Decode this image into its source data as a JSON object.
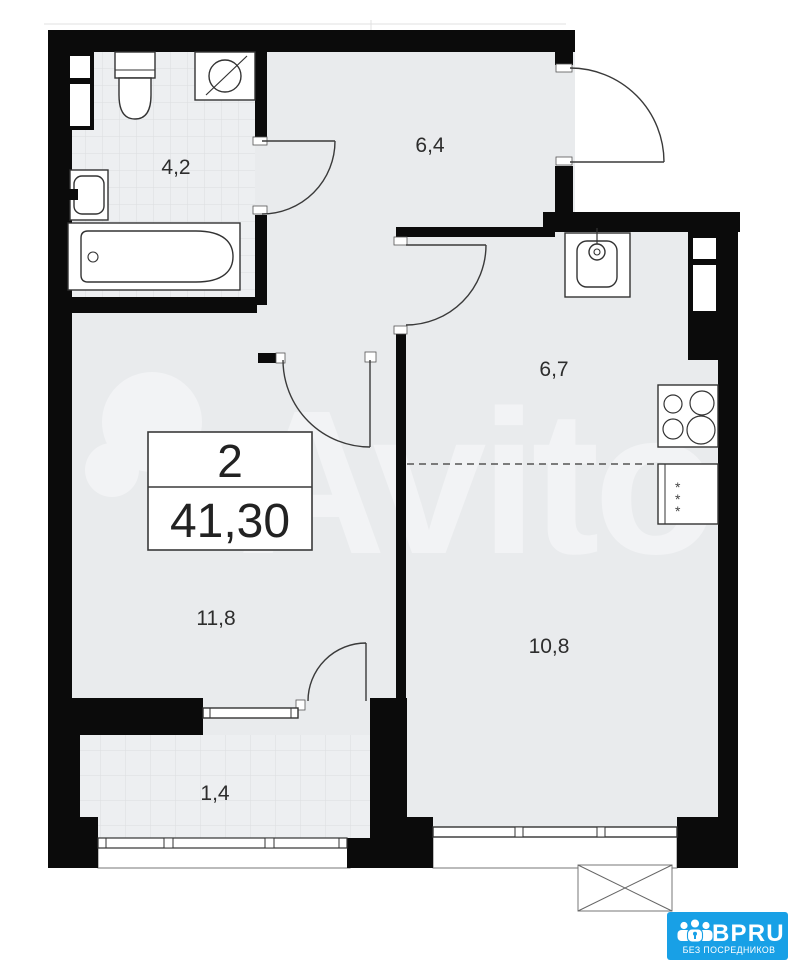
{
  "plan": {
    "info_box": {
      "rooms_count": "2",
      "total_area": "41,30"
    },
    "rooms": {
      "bathroom": "4,2",
      "hallway": "6,4",
      "kitchen": "6,7",
      "living_room": "11,8",
      "room": "10,8",
      "balcony": "1,4"
    },
    "watermark": "Avito"
  },
  "footer_logo": {
    "brand": "BPRU",
    "tagline": "БЕЗ ПОСРЕДНИКОВ",
    "bg_color": "#18a0e6"
  },
  "colors": {
    "wall": "#0b0b0b",
    "floor": "#e9ebed",
    "line": "#3a3a3a",
    "accent_blue": "#18a0e6"
  }
}
